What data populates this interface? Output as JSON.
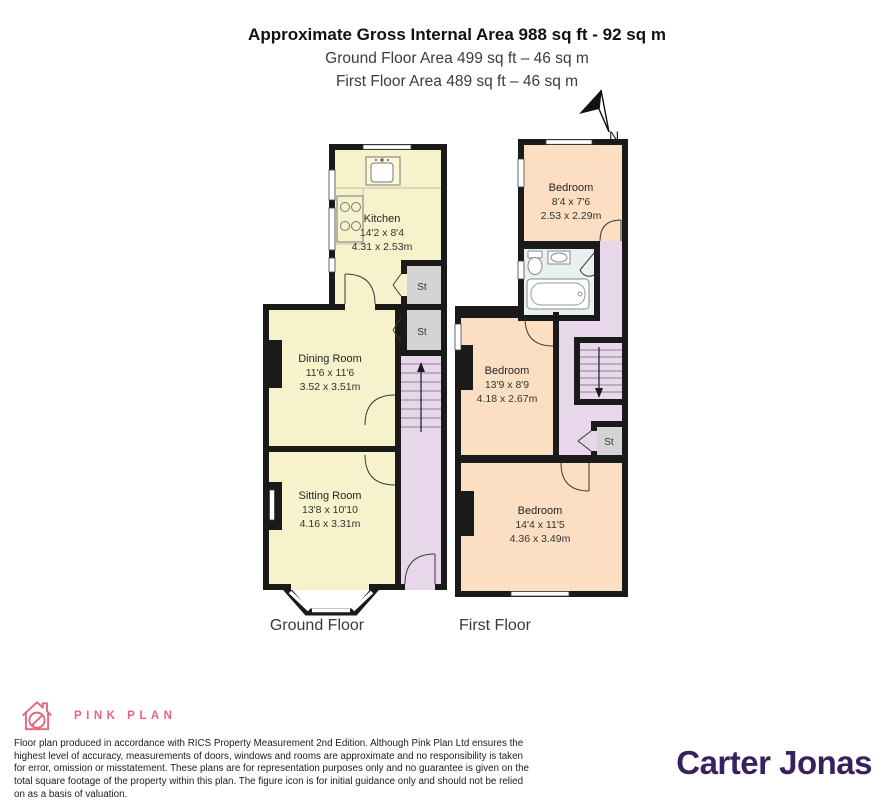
{
  "header": {
    "title": "Approximate Gross Internal Area 988 sq ft - 92 sq m",
    "subtitle_ground": "Ground Floor Area 499 sq ft – 46 sq m",
    "subtitle_first": "First Floor Area 489 sq ft – 46 sq m",
    "north_label": "N"
  },
  "ground_floor": {
    "label": "Ground Floor",
    "kitchen": {
      "name": "Kitchen",
      "imperial": "14'2 x 8'4",
      "metric": "4.31 x 2.53m"
    },
    "dining_room": {
      "name": "Dining Room",
      "imperial": "11'6 x 11'6",
      "metric": "3.52 x 3.51m"
    },
    "sitting_room": {
      "name": "Sitting Room",
      "imperial": "13'8 x 10'10",
      "metric": "4.16 x 3.31m"
    },
    "storage_upper": "St",
    "storage_lower": "St"
  },
  "first_floor": {
    "label": "First Floor",
    "bedroom_rear": {
      "name": "Bedroom",
      "imperial": "8'4 x 7'6",
      "metric": "2.53 x 2.29m"
    },
    "bedroom_middle": {
      "name": "Bedroom",
      "imperial": "13'9 x 8'9",
      "metric": "4.18 x 2.67m"
    },
    "bedroom_front": {
      "name": "Bedroom",
      "imperial": "14'4 x 11'5",
      "metric": "4.36 x 3.49m"
    },
    "storage": "St"
  },
  "footer": {
    "brand_name": "PINK PLAN",
    "disclaimer": "Floor plan produced in accordance with RICS Property Measurement 2nd Edition. Although Pink Plan Ltd ensures the highest level of accuracy, measurements of doors, windows and rooms are approximate and no responsibility is taken for error, omission or misstatement. These plans are for representation purposes only and no guarantee is given on the total square footage of the property within this plan. The figure icon is for initial guidance only and should not be relied on as a basis of valuation.",
    "agency_name": "Carter Jonas"
  },
  "colors": {
    "wall": "#1a1a1a",
    "room_cream": "#f6f2cc",
    "room_peach": "#fcdfc2",
    "hall_lavender": "#e8d7eb",
    "storage_gray": "#d4d4d4",
    "bathroom_pale": "#e9f1ef",
    "brand_pink": "#e4657e",
    "agency_purple": "#38215f"
  }
}
